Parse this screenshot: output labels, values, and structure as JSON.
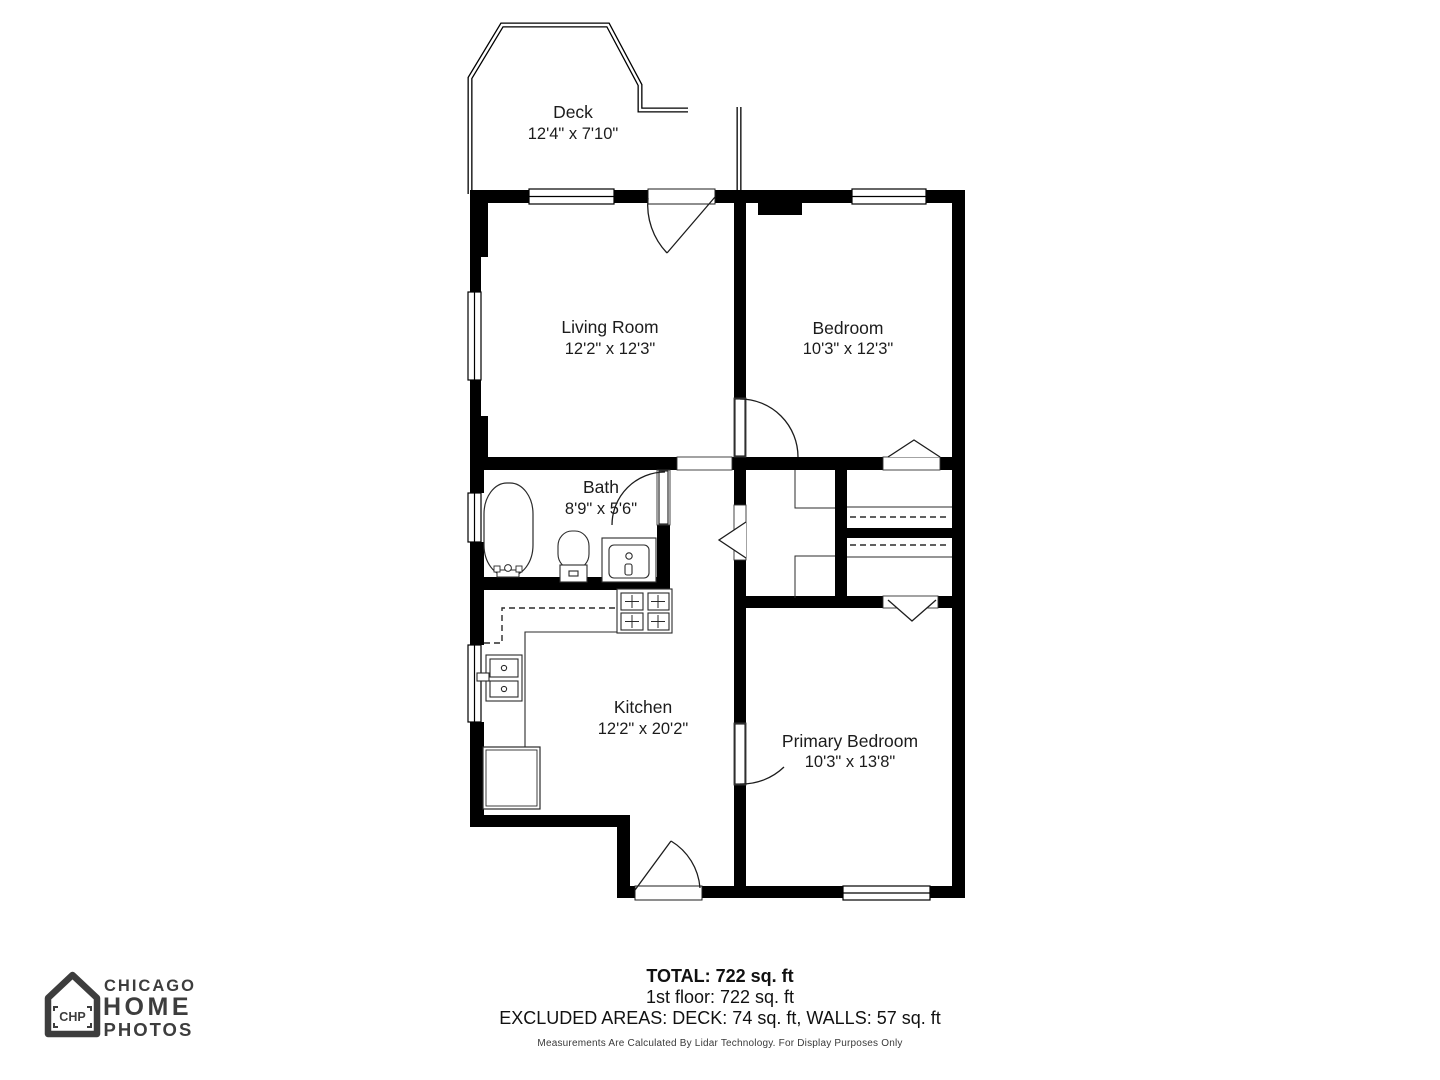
{
  "colors": {
    "wall": "#000000",
    "fixture_line": "#2b2b2b",
    "logo": "#3d3d3d",
    "background": "#ffffff"
  },
  "rooms": [
    {
      "id": "deck",
      "name": "Deck",
      "dims": "12'4\" x 7'10\""
    },
    {
      "id": "living-room",
      "name": "Living Room",
      "dims": "12'2\" x 12'3\""
    },
    {
      "id": "bedroom",
      "name": "Bedroom",
      "dims": "10'3\" x 12'3\""
    },
    {
      "id": "bath",
      "name": "Bath",
      "dims": "8'9\" x 5'6\""
    },
    {
      "id": "kitchen",
      "name": "Kitchen",
      "dims": "12'2\" x 20'2\""
    },
    {
      "id": "primary-bedroom",
      "name": "Primary Bedroom",
      "dims": "10'3\" x 13'8\""
    }
  ],
  "summary": {
    "total": "TOTAL: 722 sq. ft",
    "floor": "1st floor: 722 sq. ft",
    "excluded": "EXCLUDED AREAS: DECK: 74 sq. ft, WALLS: 57 sq. ft",
    "disclaimer": "Measurements Are Calculated By Lidar Technology. For Display Purposes Only"
  },
  "logo": {
    "monogram": "CHP",
    "line1": "CHICAGO",
    "line2": "HOME",
    "line3": "PHOTOS"
  }
}
